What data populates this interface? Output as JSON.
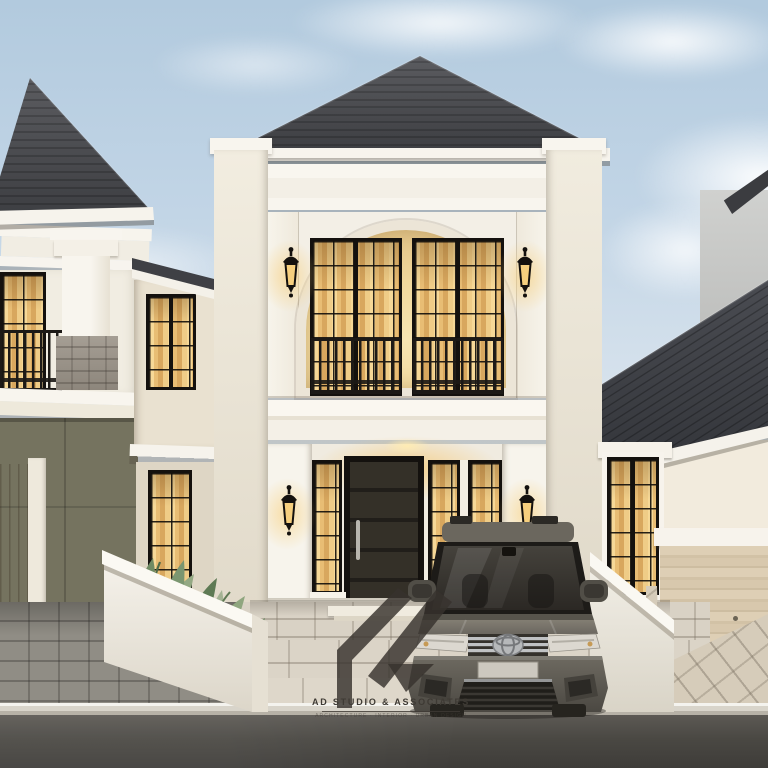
{
  "meta": {
    "scene": "two-storey classical house exterior 3d visualization at dusk"
  },
  "watermark": {
    "studio_name": "AD STUDIO & ASSOCIATES",
    "tagline": "ARCHITECTURE · INTERIOR · URBAN DESIGN",
    "logo": "ad-studio-monogram"
  },
  "palette": {
    "sky_top": "#b2cade",
    "sky_horizon": "#f2f0ec",
    "roof_dark": "#45464b",
    "facade_white": "#f4f0e7",
    "warm_window_light": "#f2cf8a",
    "window_frame": "#14110e",
    "olive_wall": "#75735f",
    "stone_pier": "#9a938a",
    "travertine_garage": "#d7c8ad",
    "paver_light": "#d9d2c5",
    "paver_dark": "#908d85",
    "asphalt": "#45433f",
    "car_body": "#6e6a61",
    "leaf_green": "#7b9670"
  },
  "objects": {
    "main_house": "white two-storey facade with arched recess and lanterns",
    "left_house": "neighbour house with balcony and stone pier",
    "right_house": "neighbour house with travertine garage door",
    "car": "grey Toyota MPV parked on driveway",
    "planter": "white planter fence with tropical plants",
    "street": "paved driveway, kerb and asphalt road"
  }
}
